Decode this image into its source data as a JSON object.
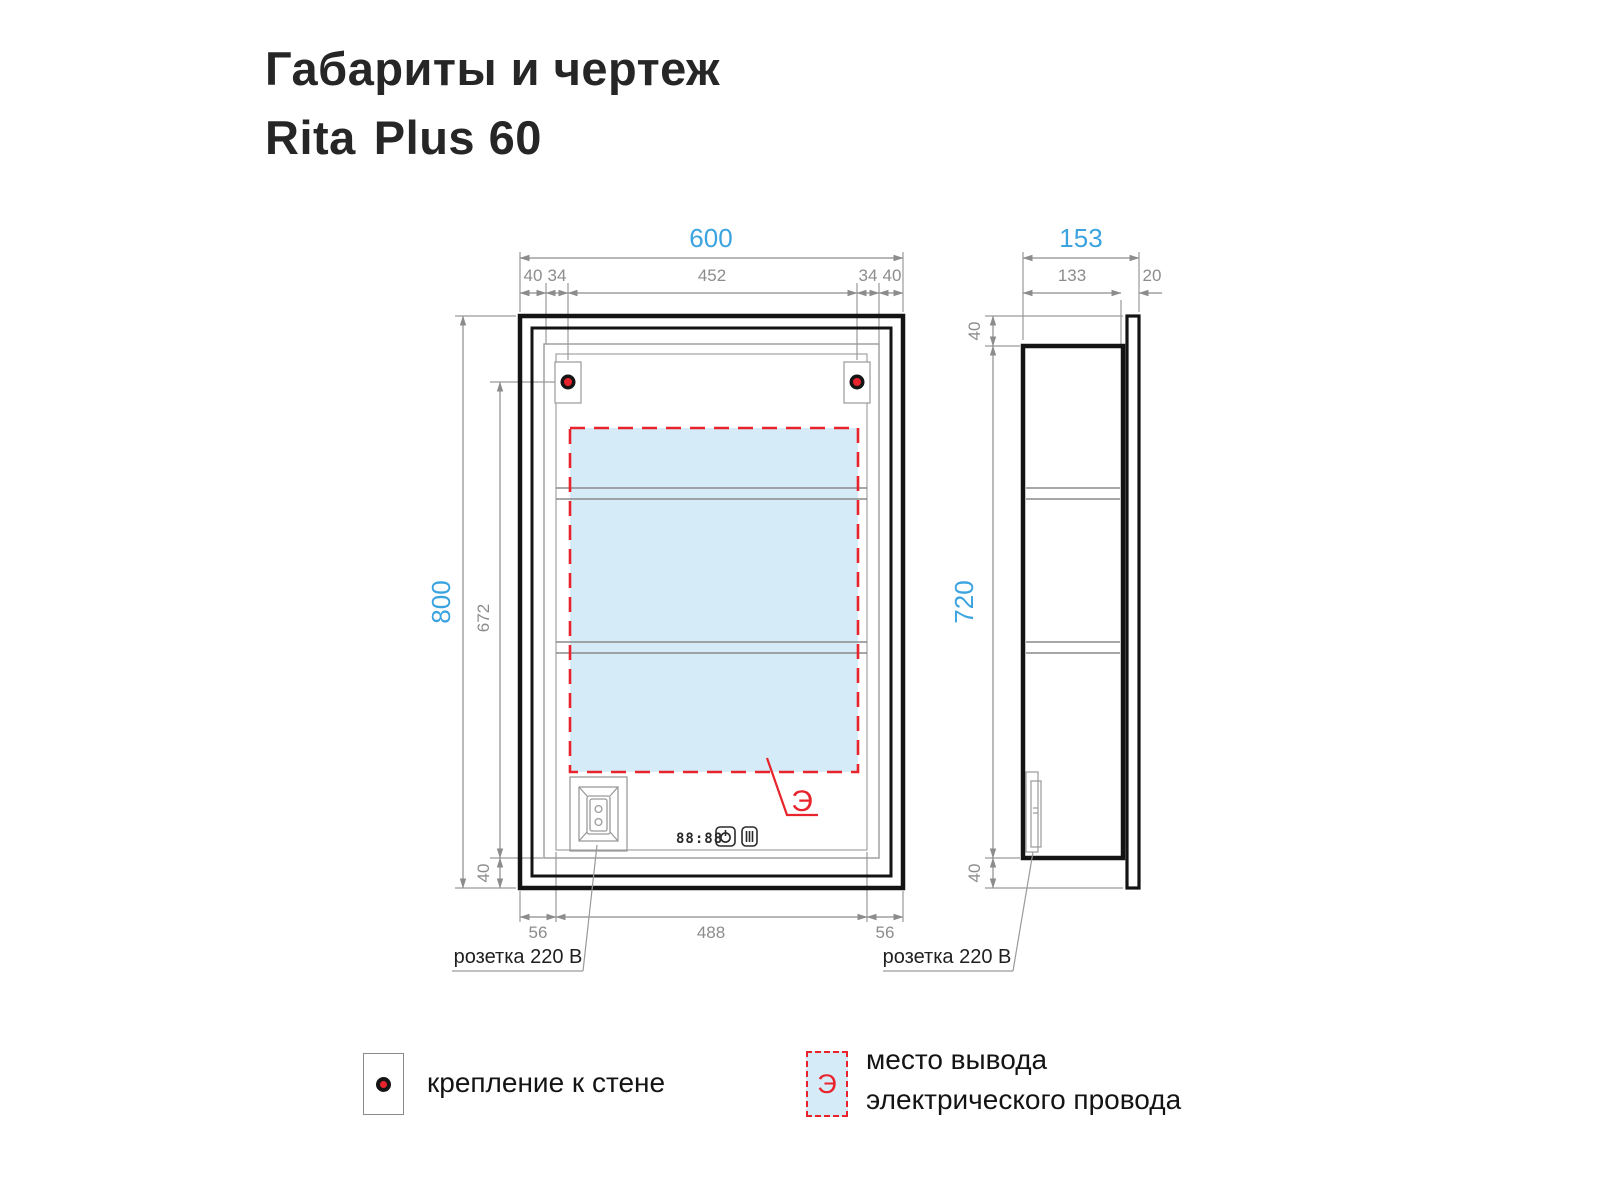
{
  "title": {
    "line1": "Габариты и чертеж",
    "brand": "Rita",
    "model": "Plus 60"
  },
  "front": {
    "dim_width": "600",
    "top_segments": [
      "40",
      "34",
      "452",
      "34",
      "40"
    ],
    "dim_height": "800",
    "dim_inner_height": "672",
    "dim_bottom_offset": "40",
    "bottom_segments": [
      "56",
      "488",
      "56"
    ],
    "socket_label": "розетка 220 В",
    "electric_mark": "Э",
    "display_digits": "88:88"
  },
  "side": {
    "dim_depth": "153",
    "dim_body_depth": "133",
    "dim_door_depth": "20",
    "offset_top": "40",
    "dim_height": "720",
    "offset_bottom": "40",
    "socket_label": "розетка 220 В"
  },
  "legend": {
    "mount_label": "крепление к стене",
    "electric_symbol": "Э",
    "electric_line1": "место вывода",
    "electric_line2": "электрического провода"
  },
  "colors": {
    "accent_blue": "#3aa3e0",
    "dim_gray": "#8c8c8c",
    "line_black": "#141414",
    "red": "#e8232b",
    "electric_fill": "#d6ebf8"
  }
}
